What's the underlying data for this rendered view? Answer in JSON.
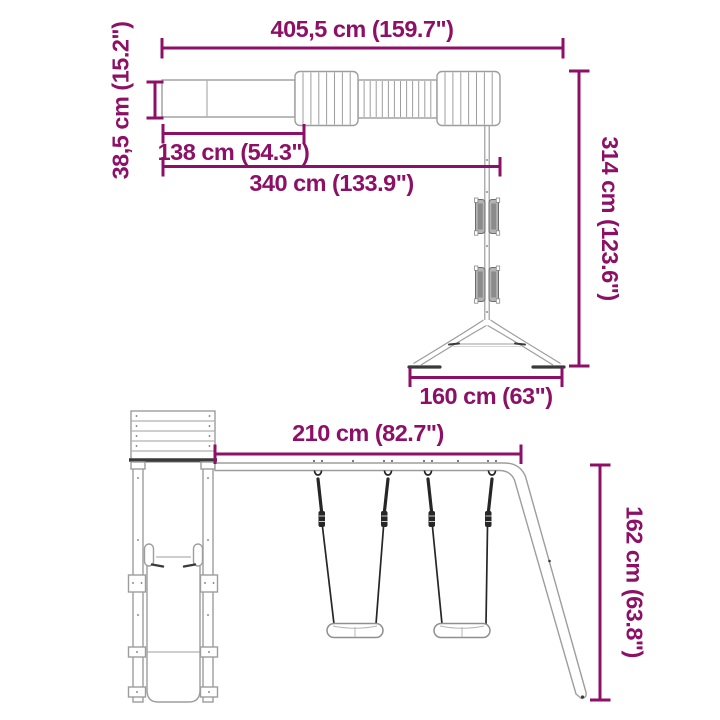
{
  "colors": {
    "dimension_accent": "#8C1166",
    "structure_outline": "#9D9D9D",
    "structure_dark": "#3A3A3A",
    "rope": "#262626",
    "background": "#FFFFFF"
  },
  "views": {
    "top_view": {
      "total_width": "405,5 cm (159.7\")",
      "depth": "38,5 cm (15.2\")",
      "platform_length": "138 cm (54.3\")",
      "span_length": "340 cm (133.9\")",
      "total_depth": "314 cm (123.6\")",
      "frame_base_width": "160 cm (63\")"
    },
    "front_view": {
      "beam_length": "210 cm (82.7\")",
      "height": "162 cm (63.8\")"
    }
  }
}
